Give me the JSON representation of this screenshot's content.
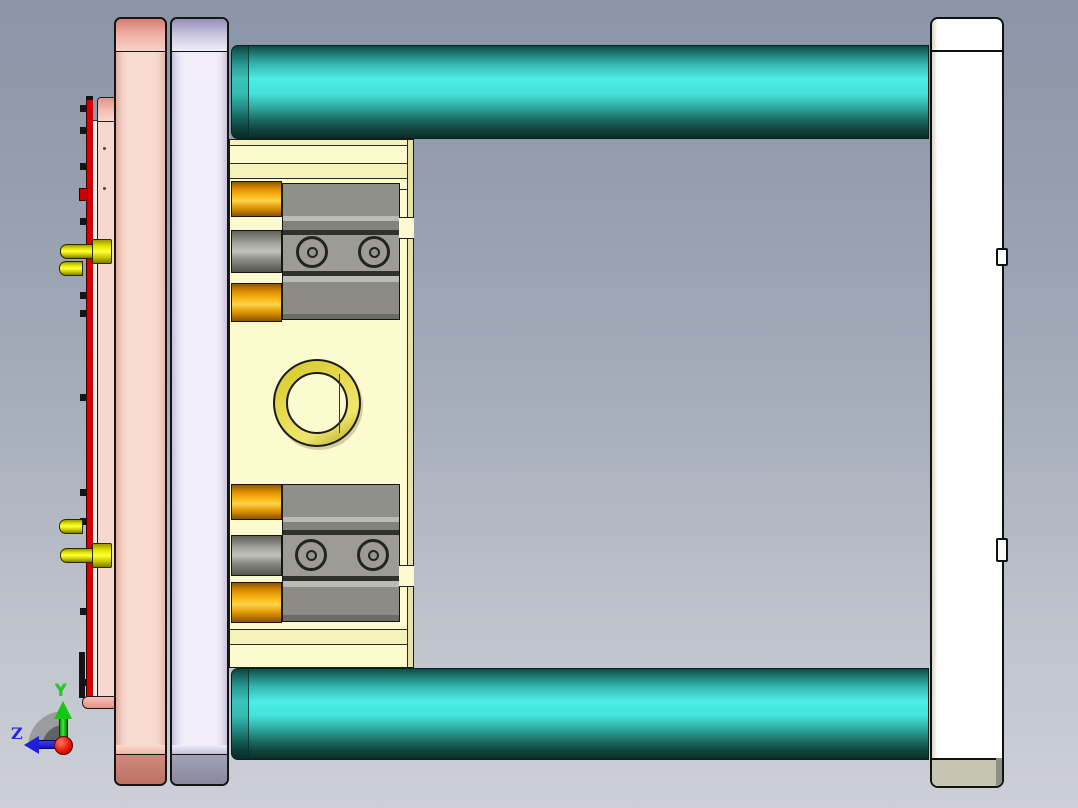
{
  "scene": {
    "description": "3D CAD viewport showing an injection mold assembly in side view",
    "axis_triad": {
      "y_label": "Y",
      "z_label": "Z",
      "y_color": "#19d419",
      "z_color": "#2525e0",
      "origin_color": "#e81400"
    },
    "background": {
      "top": "#8a96a8",
      "bottom": "#cccfd7"
    }
  },
  "parts": [
    {
      "name": "ejector-plate-edge",
      "color": "#d60000"
    },
    {
      "name": "rear-clamp-plate-small",
      "color": "#f8d8ce"
    },
    {
      "name": "cavity-plate-pink",
      "color": "#f8dbd1"
    },
    {
      "name": "core-plate-lavender",
      "color": "#f1eefa"
    },
    {
      "name": "mold-insert-block",
      "color": "#fcfacf"
    },
    {
      "name": "locating-ring",
      "color": "#e6db52"
    },
    {
      "name": "guide-pillar-top",
      "color": "#43e2da"
    },
    {
      "name": "guide-pillar-bottom",
      "color": "#43e2da"
    },
    {
      "name": "slide-unit-top",
      "color": "#9c9c94"
    },
    {
      "name": "slide-unit-bottom",
      "color": "#9c9c94"
    },
    {
      "name": "bushing-orange",
      "color": "#ffbe1e"
    },
    {
      "name": "support-pin-yellow",
      "color": "#ffff3c"
    },
    {
      "name": "clamp-plate-white",
      "color": "#ffffff"
    },
    {
      "name": "plate-foot-beige",
      "color": "#c6c5b1"
    }
  ]
}
